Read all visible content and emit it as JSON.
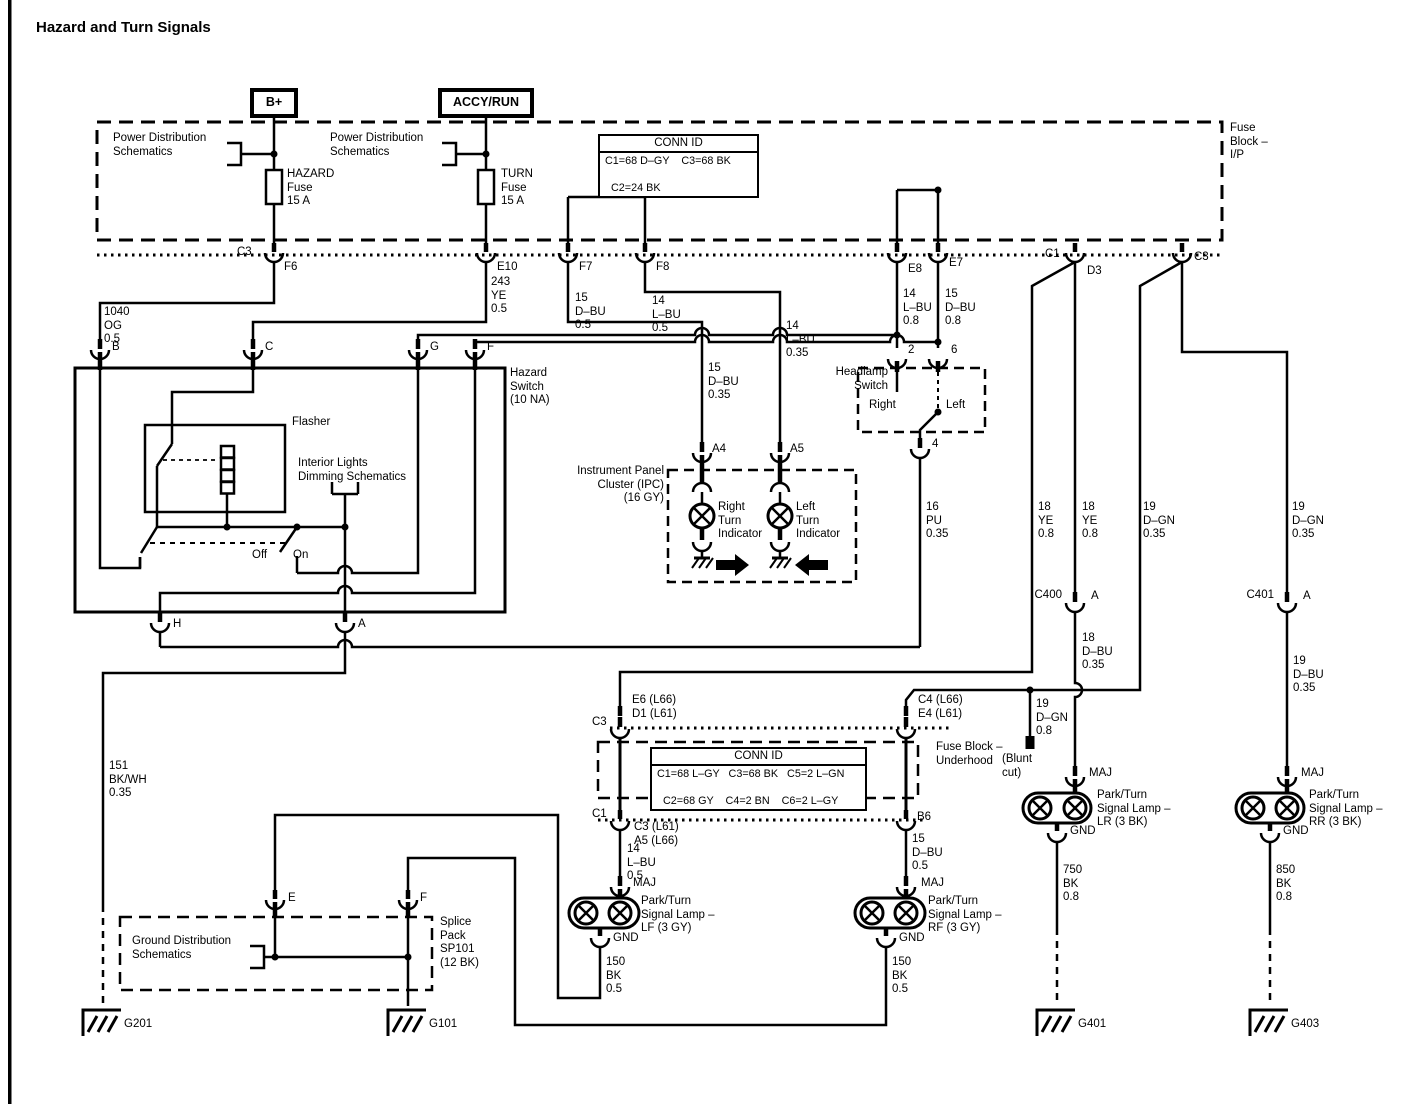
{
  "title": "Hazard and Turn Signals",
  "colors": {
    "ink": "#000000",
    "background": "#ffffff"
  },
  "power": {
    "b_plus": "B+",
    "accy_run": "ACCY/RUN",
    "pds1": "Power Distribution\nSchematics",
    "pds2": "Power Distribution\nSchematics",
    "hazard_fuse": "HAZARD\nFuse\n15 A",
    "turn_fuse": "TURN\nFuse\n15 A"
  },
  "fuse_block_ip": {
    "label": "Fuse\nBlock –\nI/P",
    "conn_id": {
      "header": "CONN ID",
      "row1": "C1=68 D–GY    C3=68 BK",
      "row2": "C2=24 BK"
    },
    "pins": {
      "c3_left": "C3",
      "f6": "F6",
      "e10": "E10",
      "f7": "F7",
      "f8": "F8",
      "e8": "E8",
      "e7": "E7",
      "c1": "C1",
      "d3": "D3",
      "c3_right": "C3"
    }
  },
  "wires": {
    "og1040": "1040\nOG\n0.5",
    "ye243": "243\nYE\n0.5",
    "dbu15_05": "15\nD–BU\n0.5",
    "lbu14_05": "14\nL–BU\n0.5",
    "dbu15_035": "15\nD–BU\n0.35",
    "lbu14_035": "14\nL–BU\n0.35",
    "lbu14_08": "14\nL–BU\n0.8",
    "dbu15_08": "15\nD–BU\n0.8",
    "pu16": "16\nPU\n0.35",
    "ye18_a": "18\nYE\n0.8",
    "ye18_b": "18\nYE\n0.8",
    "dgn19_a": "19\nD–GN\n0.35",
    "dgn19_b": "19\nD–GN\n0.35",
    "dbu18": "18\nD–BU\n0.35",
    "dgn19_08": "19\nD–GN\n0.8",
    "dbu19": "19\nD–BU\n0.35",
    "bkwh151": "151\nBK/WH\n0.35",
    "lf_feed": "14\nL–BU\n0.5",
    "rf_feed": "15\nD–BU\n0.5",
    "lf_gnd": "150\nBK\n0.5",
    "rf_gnd": "150\nBK\n0.5",
    "lr_gnd": "750\nBK\n0.8",
    "rr_gnd": "850\nBK\n0.8"
  },
  "hazard_switch": {
    "label": "Hazard\nSwitch\n(10 NA)",
    "flasher": "Flasher",
    "dimming": "Interior Lights\nDimming Schematics",
    "off": "Off",
    "on": "On",
    "pins": {
      "b": "B",
      "c": "C",
      "g": "G",
      "f": "F",
      "h": "H",
      "a": "A"
    }
  },
  "headlamp_switch": {
    "label": "Headlamp\nSwitch",
    "right": "Right",
    "left": "Left",
    "pins": {
      "p2": "2",
      "p6": "6",
      "p4": "4"
    }
  },
  "ipc": {
    "label": "Instrument Panel\nCluster (IPC)\n(16 GY)",
    "right_indicator": "Right\nTurn\nIndicator",
    "left_indicator": "Left\nTurn\nIndicator",
    "pins": {
      "a4": "A4",
      "a5": "A5"
    }
  },
  "inline_connectors": {
    "c400": "C400",
    "c400_pin": "A",
    "c401": "C401",
    "c401_pin": "A",
    "blunt_cut": "(Blunt\ncut)"
  },
  "fuse_block_underhood": {
    "label": "Fuse Block –\nUnderhood",
    "conn_id": {
      "header": "CONN ID",
      "row1": "C1=68 L–GY   C3=68 BK   C5=2 L–GN",
      "row2": "C2=68 GY    C4=2 BN    C6=2 L–GY"
    },
    "pins": {
      "c3_top": "C3",
      "e6_d1": "E6 (L66)\nD1 (L61)",
      "c4_e4": "C4 (L66)\nE4 (L61)",
      "c1_bottom": "C1",
      "c1_pins": "C3 (L61)\nA5 (L66)",
      "b6": "B6"
    }
  },
  "lamps": {
    "lf": {
      "maj": "MAJ",
      "gnd": "GND",
      "label": "Park/Turn\nSignal Lamp –\nLF (3 GY)"
    },
    "rf": {
      "maj": "MAJ",
      "gnd": "GND",
      "label": "Park/Turn\nSignal Lamp –\nRF (3 GY)"
    },
    "lr": {
      "maj": "MAJ",
      "gnd": "GND",
      "label": "Park/Turn\nSignal Lamp –\nLR (3 BK)"
    },
    "rr": {
      "maj": "MAJ",
      "gnd": "GND",
      "label": "Park/Turn\nSignal Lamp –\nRR (3 BK)"
    }
  },
  "splice_pack": {
    "label": "Splice\nPack\nSP101\n(12 BK)",
    "ground_dist": "Ground Distribution\nSchematics",
    "pins": {
      "e": "E",
      "f": "F"
    }
  },
  "grounds": {
    "g201": "G201",
    "g101": "G101",
    "g401": "G401",
    "g403": "G403"
  }
}
